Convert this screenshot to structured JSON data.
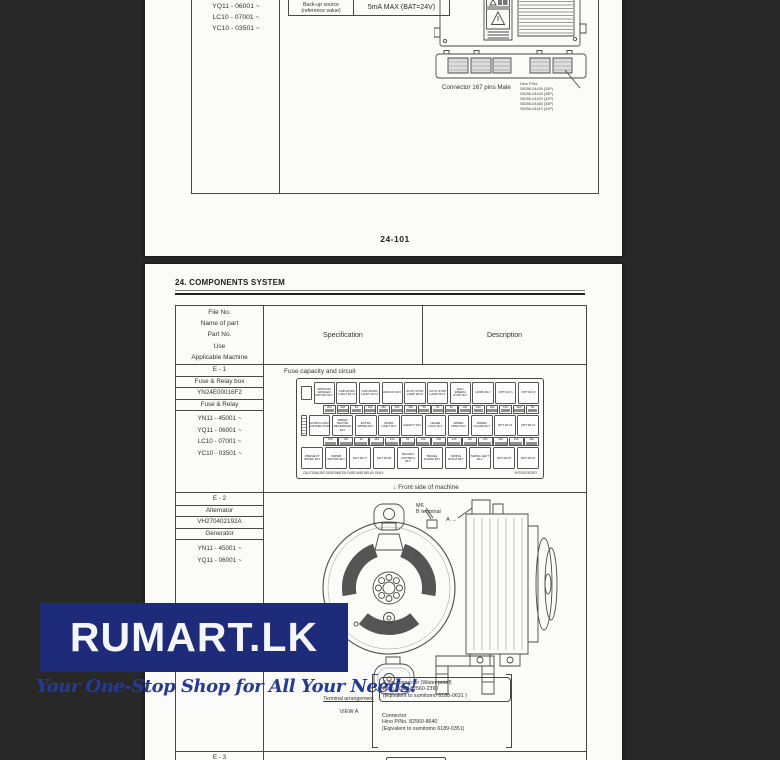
{
  "colors": {
    "background": "#282828",
    "page": "#fbfbfa",
    "logo_box": "#1e2a7a",
    "logo_text": "#f5f6fa",
    "tagline": "#243a9b"
  },
  "logo": {
    "text": "RUMART.LK",
    "tagline": "Your One-Stop Shop for All Your Needs!"
  },
  "page_top": {
    "machines": [
      "YQ11 - 06001 ~",
      "LC10 - 07001 ~",
      "YC10 - 03501 ~"
    ],
    "backup_row": {
      "label_lines": [
        "Back-up source",
        "(reference value)"
      ],
      "value": "5mA MAX (BAT=24V)"
    },
    "connector_caption": "Connector 167 pins Male",
    "hino_pns_title": "Hino P/Ns.",
    "hino_pns": [
      "S8256-04430 (34P)",
      "S8256-04440 (35P)",
      "S8256-04420 (32P)",
      "S8256-04480 (33P)",
      "S8256-04410 (31P)"
    ],
    "page_number": "24-101"
  },
  "page_bottom": {
    "title": "24. COMPONENTS SYSTEM",
    "table_header": {
      "col1_lines": [
        "File No.",
        "Name of part",
        "Part No.",
        "Use",
        "Applicable Machine"
      ],
      "col2": "Specification",
      "col3": "Description"
    },
    "e1": {
      "file_no": "E - 1",
      "name": "Fuse & Relay box",
      "part_no": "YN24E00016F2",
      "use": "Fuse & Relay",
      "machines": [
        "YN11 - 45001 ~",
        "YQ11 - 06001 ~",
        "LC10 - 07001 ~",
        "YC10 - 03501 ~"
      ]
    },
    "fuse_box": {
      "label": "Fuse capacity and circuit",
      "row1": [
        "WINDOW WASHER MOTOR RLY",
        "CAB WORK LIGHT RLY1",
        "CAB WORK LIGHT RLY2",
        "AIRCON RLY",
        "AUTO STOP LAMP RLY2",
        "AUTO STOP LAMP RLY1",
        "ENG EMERG STOP RLY",
        "HORN RLY",
        "OPT RLY1",
        "OPT RLY2"
      ],
      "strip1": [
        "20A",
        "20A",
        "5A",
        "25A",
        "25A",
        "15A",
        "15A",
        "5A",
        "5A",
        "5A",
        "10A",
        "10A",
        "10A",
        "10A",
        "20A",
        "5A"
      ],
      "row2": [
        "DOWN LOAD CONNECTOR",
        "WIPER MOTOR REVERSING RLY",
        "EXTRA WIPER RLY",
        "WORK LIGHT RLY",
        "SAFETY RLY",
        "LEVER LOCK RLY",
        "WIPER OPEN RLY",
        "WIPER CLOSE RLY",
        "OPT RLY3",
        "OPT RLY4"
      ],
      "strip2": [
        "15A",
        "10A",
        "5A",
        "25A",
        "10A",
        "5A",
        "10A",
        "20A",
        "10A",
        "10A",
        "15A",
        "10A",
        "10A",
        "20A"
      ],
      "row3": [
        "PREVENT SPARK RLY",
        "WIPER MOTOR RLY",
        "OPT RLY7",
        "OPT RLY8",
        "BUCKET CONTROL RLY",
        "TRAVEL ALARM RLY",
        "SWING RIGHT RLY",
        "SWING LEFT RLY",
        "OPT RLY5",
        "OPT RLY6"
      ],
      "caution": "CAUTION/USE DESIGNATED FUSE AND RELAY ONLY.",
      "code": "YHT00101E3P2",
      "front_note": "↓    Front side of machine"
    },
    "e2": {
      "file_no": "E - 2",
      "name": "Alternator",
      "part_no": "VH270402192A",
      "use": "Generator",
      "machines": [
        "YN11 - 45001 ~",
        "YQ11 - 06001 ~"
      ],
      "m6_label_lines": [
        "M6",
        "B terminal"
      ],
      "a_label": "A →",
      "terminal_arrangement": "Terminal arrangement",
      "view_a": "VIEW A",
      "note1_lines": [
        "4 pin connector (Water proof)",
        "Hino P/No. 82560-2390",
        "(Eqivalent to sumitomo 6188-0631 )"
      ],
      "note2_lines": [
        "Connector",
        "Hino P/No. 82560-8640",
        "(Eqivalent to sumitomo 6189-0351)"
      ]
    },
    "e3": {
      "file_no": "E - 3"
    }
  }
}
